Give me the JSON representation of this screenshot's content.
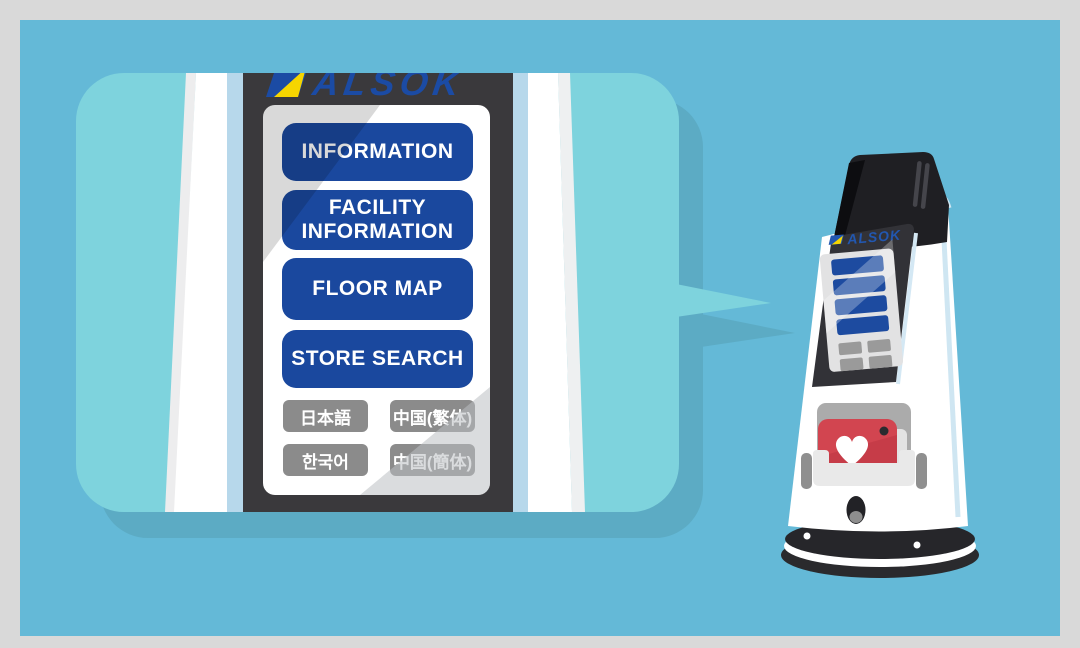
{
  "palette": {
    "frame": "#d9d9d9",
    "background": "#64b9d7",
    "bubble_fill": "#7ed3dd",
    "bubble_shadow": "#5cabc4",
    "bezel": "#3a393c",
    "menu_button": "#1a489e",
    "language_button": "#8b8b8b",
    "brand_blue": "#1b4ba4",
    "brand_yellow": "#f6d500",
    "aed_red": "#d24550"
  },
  "kiosk_display": {
    "brand": "ALSOK",
    "menu_buttons": [
      {
        "label": "INFORMATION"
      },
      {
        "label": "FACILITY INFORMATION"
      },
      {
        "label": "FLOOR MAP"
      },
      {
        "label": "STORE SEARCH"
      }
    ],
    "language_buttons": [
      {
        "label": "日本語"
      },
      {
        "label": "中国(繁体)"
      },
      {
        "label": "한국어"
      },
      {
        "label": "中国(簡体)"
      }
    ]
  },
  "robot": {
    "brand": "ALSOK"
  }
}
